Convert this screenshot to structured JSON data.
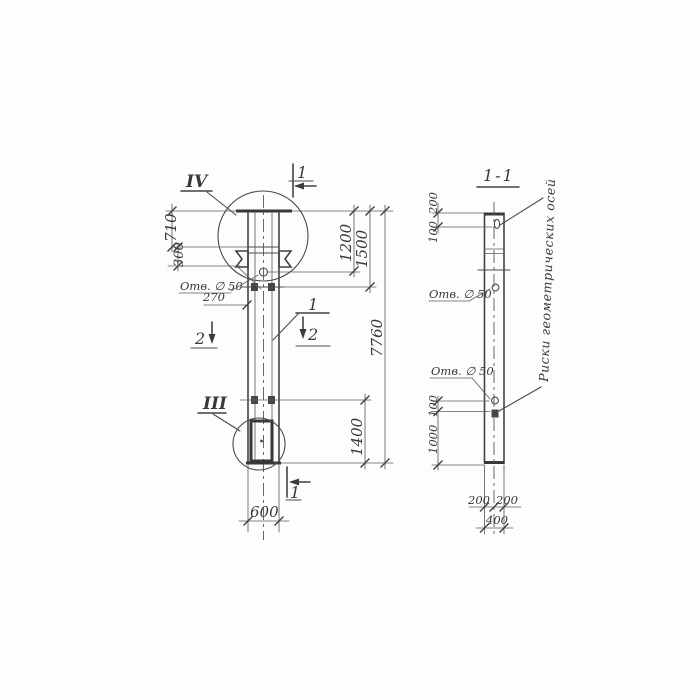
{
  "colors": {
    "ink": "#3f3f3f",
    "paper": "#fdfdfd"
  },
  "elevation": {
    "detail_top": "IV",
    "detail_bottom": "III",
    "section_cut_top": "1",
    "section_cut_bottom": "1",
    "section_cut_2": "2",
    "part_number": "1",
    "hole_note": "Отв. ∅ 50",
    "dim_710": "710",
    "dim_300": "300",
    "dim_270": "270",
    "dim_1200": "1200",
    "dim_1500": "1500",
    "dim_7760": "7760",
    "dim_1400": "1400",
    "dim_600": "600"
  },
  "section": {
    "title": "1-1",
    "hole_note_upper": "Отв. ∅ 50",
    "hole_note_lower": "Отв. ∅ 50",
    "dim_200_top": "200",
    "dim_100_top": "100",
    "dim_100_bottom": "100",
    "dim_1000": "1000",
    "dim_200_bottom_left": "200",
    "dim_200_bottom_right": "200",
    "dim_400": "400",
    "axes_note": "Риски геометрических осей"
  }
}
